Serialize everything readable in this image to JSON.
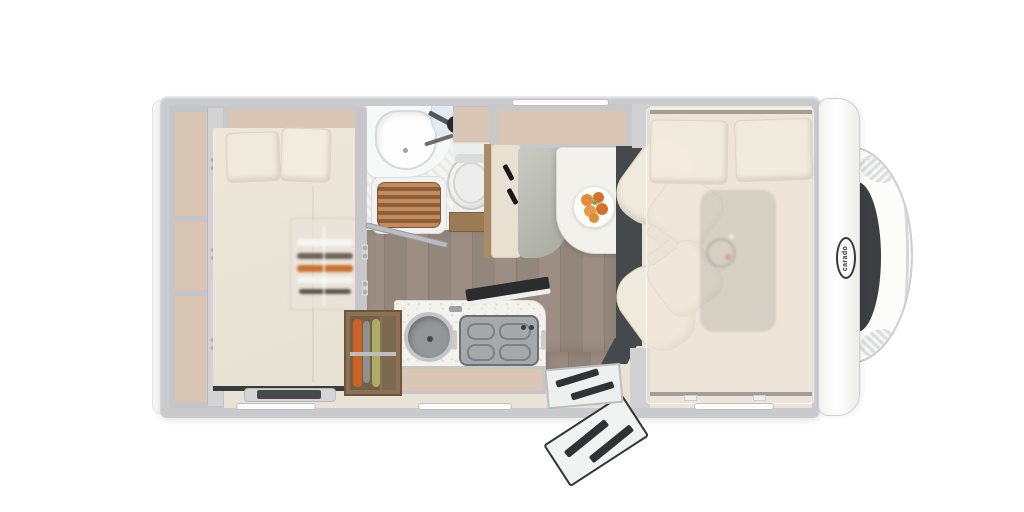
{
  "brand": {
    "logo_text": "carado"
  },
  "floorplan": {
    "view": "top-down motorhome floor plan render",
    "rooms": [
      {
        "name": "rear-bedroom",
        "features": [
          "double-bed",
          "two-pillows",
          "wardrobe-with-3-shelves",
          "overhead-cabinet",
          "hanging-wardrobe",
          "floor-hatch"
        ]
      },
      {
        "name": "bathroom",
        "features": [
          "washbasin",
          "faucet",
          "teak-shower-grate",
          "toilet",
          "wood-vanity",
          "swing-door-open"
        ]
      },
      {
        "name": "dinette",
        "features": [
          "bench-seat",
          "two-seat-belts",
          "grey-seat-cushion",
          "table",
          "fruit-plate",
          "overhead-locker",
          "window"
        ]
      },
      {
        "name": "kitchen",
        "features": [
          "round-sink",
          "gas-hob-with-pan-supports",
          "counter",
          "open-glass-lid",
          "base-cabinet",
          "wood-storage-shelf-with-gear"
        ]
      },
      {
        "name": "entrance",
        "features": [
          "entry-step",
          "door-swung-open"
        ]
      },
      {
        "name": "cab",
        "features": [
          "driver-swivel-seat",
          "passenger-swivel-seat",
          "dashboard",
          "drop-down-bed-overlay",
          "two-pillows"
        ]
      },
      {
        "name": "front-end",
        "features": [
          "windshield",
          "hood",
          "headlights",
          "carado-badge"
        ]
      }
    ],
    "counts": {
      "cab_seats": 2,
      "rear_bed_pillows": 2,
      "drop_down_bed_pillows": 2,
      "wardrobe_shelves": 3,
      "hob_knobs": 2,
      "seat_belts": 2,
      "top_wall_windows": 1,
      "bottom_wall_windows": 3
    }
  },
  "colors": {
    "background": "#ffffff",
    "shell_grey": "#c9cacd",
    "interior_cream": "#e9e3d6",
    "furniture_beige": "#d9c6b4",
    "wood_floor": "#97897d",
    "storage_wood": "#8b7254",
    "teak_grate": "#c6895b",
    "upholstery_cream": "#f0eadc",
    "upholstery_grey": "#b8bab2",
    "dark_accent": "#3a3b3d",
    "fruit_orange": "#e28c3a",
    "gear_orange": "#cd6226",
    "gear_green": "#aaae63",
    "dashboard_red_dot": "#d23b2f"
  }
}
